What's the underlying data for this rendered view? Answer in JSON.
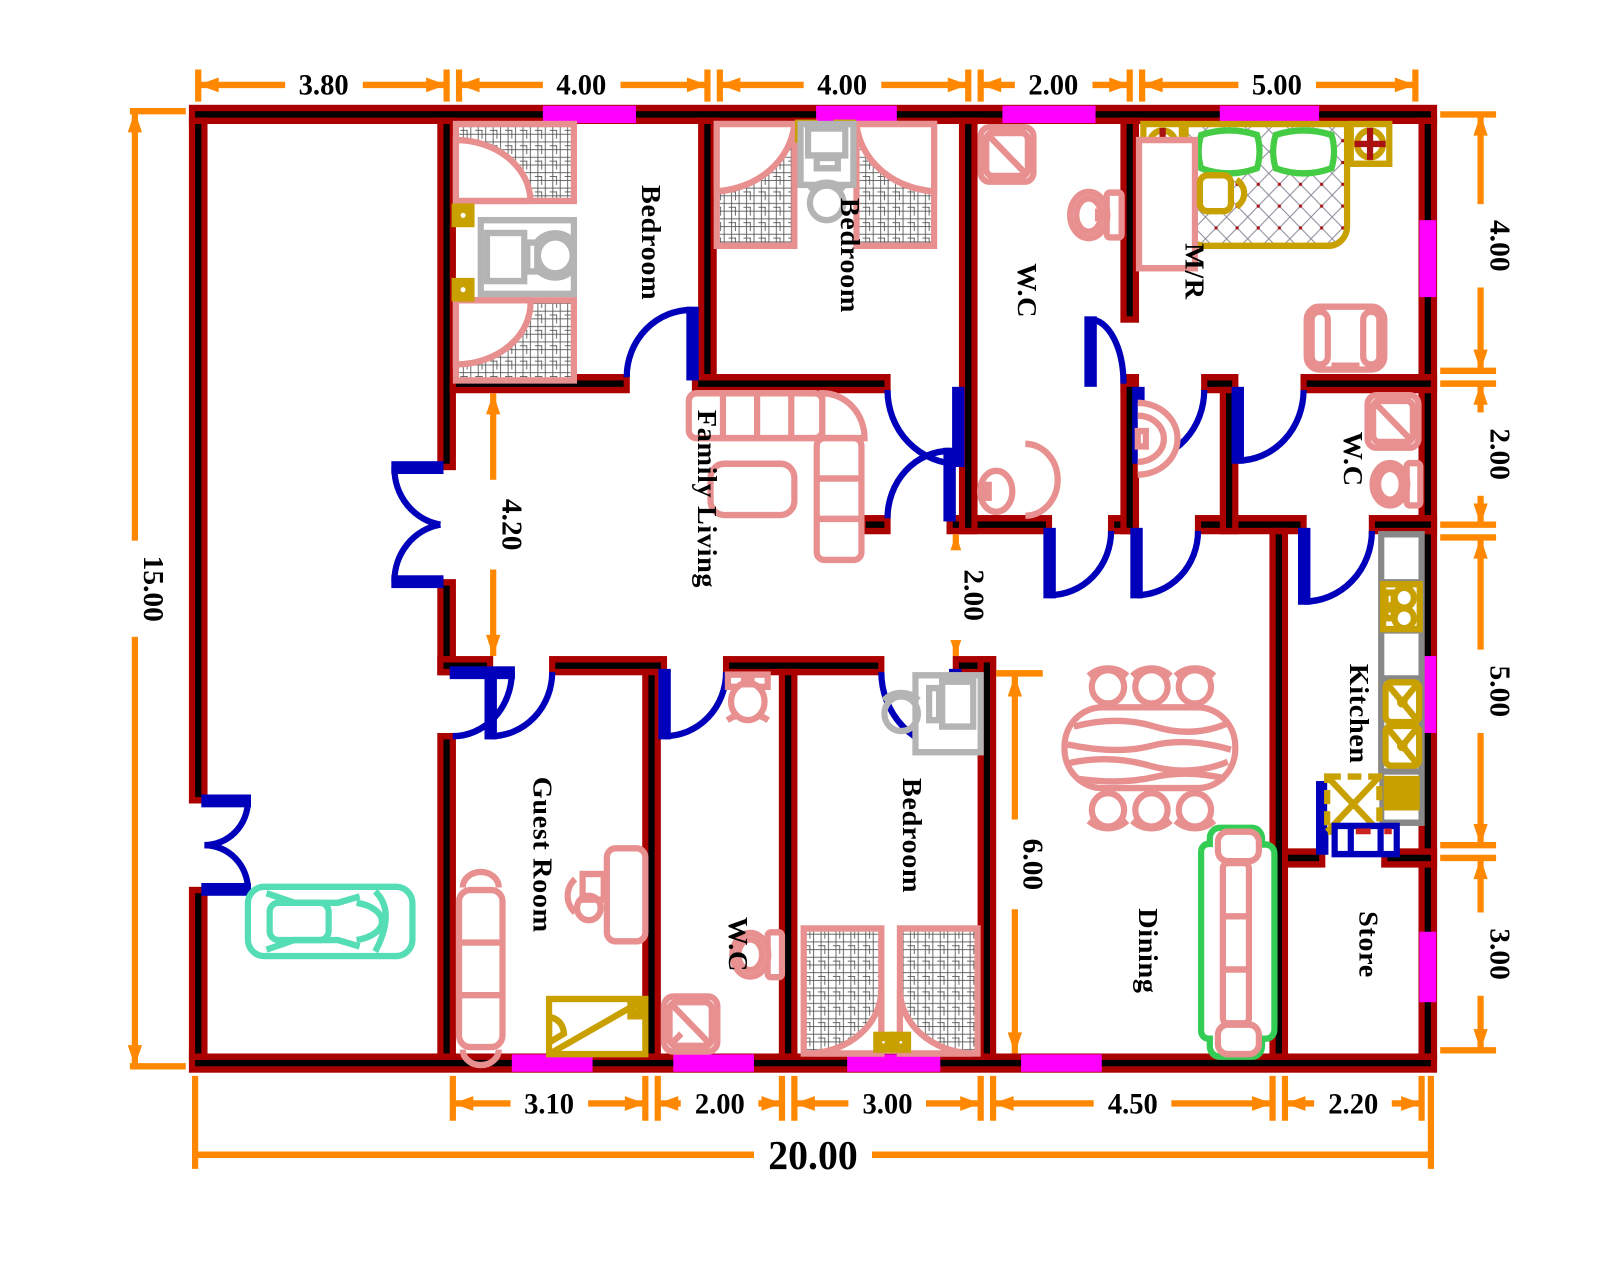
{
  "plan": {
    "title": "House floor plan 20.00 x 15.00",
    "rooms": [
      {
        "id": "bedroom-1",
        "label": "Bedroom"
      },
      {
        "id": "bedroom-2",
        "label": "Bedroom"
      },
      {
        "id": "wc-top",
        "label": "W.C"
      },
      {
        "id": "master-room",
        "label": "M/R"
      },
      {
        "id": "wc-right",
        "label": "W.C"
      },
      {
        "id": "family-living",
        "label": "Family Living"
      },
      {
        "id": "kitchen",
        "label": "Kitchen"
      },
      {
        "id": "guest-room",
        "label": "Guest Room"
      },
      {
        "id": "wc-bottom",
        "label": "W.C"
      },
      {
        "id": "bedroom-3",
        "label": "Bedroom"
      },
      {
        "id": "dining",
        "label": "Dining"
      },
      {
        "id": "store",
        "label": "Store"
      }
    ],
    "dimensions": {
      "top": [
        "3.80",
        "4.00",
        "4.00",
        "2.00",
        "5.00"
      ],
      "right": [
        "4.00",
        "2.00",
        "5.00",
        "3.00"
      ],
      "left": [
        "15.00"
      ],
      "bottom": [
        "3.10",
        "2.00",
        "3.00",
        "4.50",
        "2.20"
      ],
      "overall_width": "20.00",
      "interior": {
        "family_living_height": "4.20",
        "hall_height": "2.00",
        "dining_height": "6.00"
      }
    },
    "colors": {
      "wall": "#000000",
      "wall_edge": "#aa0000",
      "dimension": "#ff8800",
      "dimension_text": "#000000",
      "door": "#0000bb",
      "window": "#ff00ff",
      "furniture_red": "#e89090",
      "furniture_yellow": "#c8a000",
      "sofa_green": "#33cc55",
      "car_teal": "#55ddb5",
      "desk_gray": "#b4b4b4",
      "hatch_gray": "#555555"
    }
  }
}
